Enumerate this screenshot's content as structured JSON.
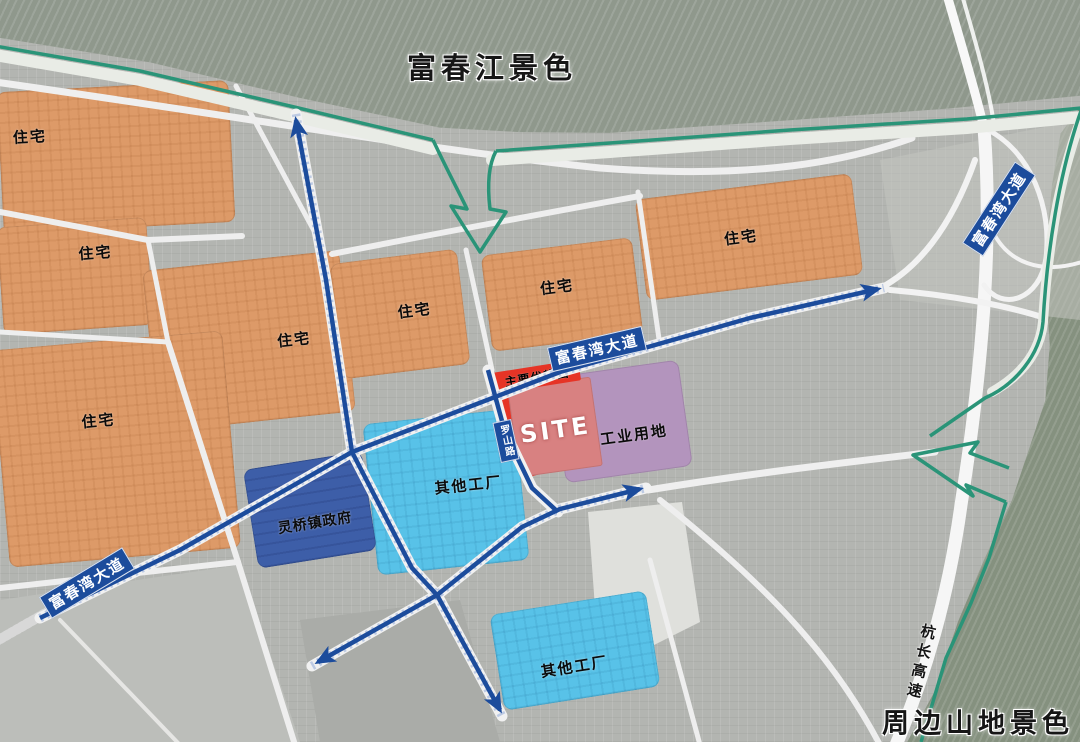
{
  "titles": {
    "river_view": "富春江景色",
    "mountain_view": "周边山地景色"
  },
  "legend_labels": {
    "residential": "住宅",
    "other_factory": "其他工厂",
    "government": "灵桥镇政府",
    "industrial": "工业用地",
    "site": "SITE",
    "advantage": "主要优势面"
  },
  "road_names": {
    "avenue": "富春湾大道",
    "luoshan": "罗山路",
    "expressway": "杭长高速"
  },
  "colors": {
    "residential": "#dd9a68",
    "factory": "#58c2e8",
    "government": "#3d5ea8",
    "industrial": "#b394bd",
    "site_fill": "#d88181",
    "site_edge": "#e63426",
    "road_blue": "#1c4c9c",
    "green_line": "#2a9478",
    "river": "#8f988c",
    "mountain": "#85917f"
  },
  "zones": [
    {
      "name": "residential-a",
      "type": "residential",
      "label_key": "residential",
      "x": 0,
      "y": 86,
      "w": 232,
      "h": 142,
      "rot": -3,
      "lox": -85,
      "loy": -25
    },
    {
      "name": "residential-b",
      "type": "residential",
      "label_key": "residential",
      "x": 0,
      "y": 222,
      "w": 150,
      "h": 108,
      "rot": -4,
      "lox": 22,
      "loy": -22
    },
    {
      "name": "residential-c",
      "type": "residential",
      "label_key": "residential",
      "x": 150,
      "y": 260,
      "w": 198,
      "h": 162,
      "rot": -6,
      "lox": 45,
      "loy": 3
    },
    {
      "name": "residential-d",
      "type": "residential",
      "label_key": "residential",
      "x": 0,
      "y": 340,
      "w": 232,
      "h": 218,
      "rot": -5,
      "lox": -15,
      "loy": -30
    },
    {
      "name": "residential-e",
      "type": "residential",
      "label_key": "residential",
      "x": 336,
      "y": 256,
      "w": 128,
      "h": 116,
      "rot": -7,
      "lox": 15,
      "loy": -2
    },
    {
      "name": "residential-f",
      "type": "residential",
      "label_key": "residential",
      "x": 486,
      "y": 246,
      "w": 152,
      "h": 97,
      "rot": -7,
      "lox": -4,
      "loy": -9
    },
    {
      "name": "residential-g",
      "type": "residential",
      "label_key": "residential",
      "x": 640,
      "y": 186,
      "w": 218,
      "h": 102,
      "rot": -7,
      "lox": -8,
      "loy": -1
    },
    {
      "name": "factory-west",
      "type": "factory",
      "label_key": "other_factory",
      "x": 370,
      "y": 416,
      "w": 152,
      "h": 152,
      "rot": -6,
      "lox": 23,
      "loy": -5
    },
    {
      "name": "factory-south",
      "type": "factory",
      "label_key": "other_factory",
      "x": 496,
      "y": 602,
      "w": 158,
      "h": 97,
      "rot": -9,
      "lox": -3,
      "loy": 15
    },
    {
      "name": "government",
      "type": "government",
      "label_key": "government",
      "x": 250,
      "y": 460,
      "w": 120,
      "h": 100,
      "rot": -9,
      "lox": 3,
      "loy": 13
    },
    {
      "name": "industrial",
      "type": "industrial",
      "label_key": "industrial",
      "x": 558,
      "y": 368,
      "w": 128,
      "h": 107,
      "rot": -8,
      "lox": 10,
      "loy": 14
    },
    {
      "name": "site-edge-strip",
      "type": "site-edge",
      "label_key": null,
      "x": 509,
      "y": 374,
      "w": 20,
      "h": 104,
      "rot": -17
    },
    {
      "name": "site",
      "type": "site",
      "label_key": "site",
      "x": 513,
      "y": 382,
      "w": 84,
      "h": 90,
      "rot": -8,
      "lox": 0,
      "loy": 3
    },
    {
      "name": "advantage-band",
      "type": "advantage",
      "label_key": "advantage",
      "x": 494,
      "y": 366,
      "w": 86,
      "h": 21,
      "rot": -9,
      "lox": 0,
      "loy": 0
    }
  ],
  "road_labels": [
    {
      "name": "avenue-label-sw",
      "key": "avenue",
      "x": 87,
      "y": 583,
      "rot": -31,
      "style": "blue"
    },
    {
      "name": "avenue-label-mid",
      "key": "avenue",
      "x": 597,
      "y": 349,
      "rot": -13,
      "style": "blue"
    },
    {
      "name": "avenue-label-ne",
      "key": "avenue",
      "x": 999,
      "y": 209,
      "rot": -57,
      "style": "blue"
    },
    {
      "name": "luoshan-label",
      "key": "luoshan",
      "x": 506,
      "y": 441,
      "rot": -12,
      "style": "blue-vertical"
    },
    {
      "name": "expressway-label",
      "key": "expressway",
      "x": 921,
      "y": 663,
      "rot": 13,
      "style": "plain-vertical"
    }
  ]
}
